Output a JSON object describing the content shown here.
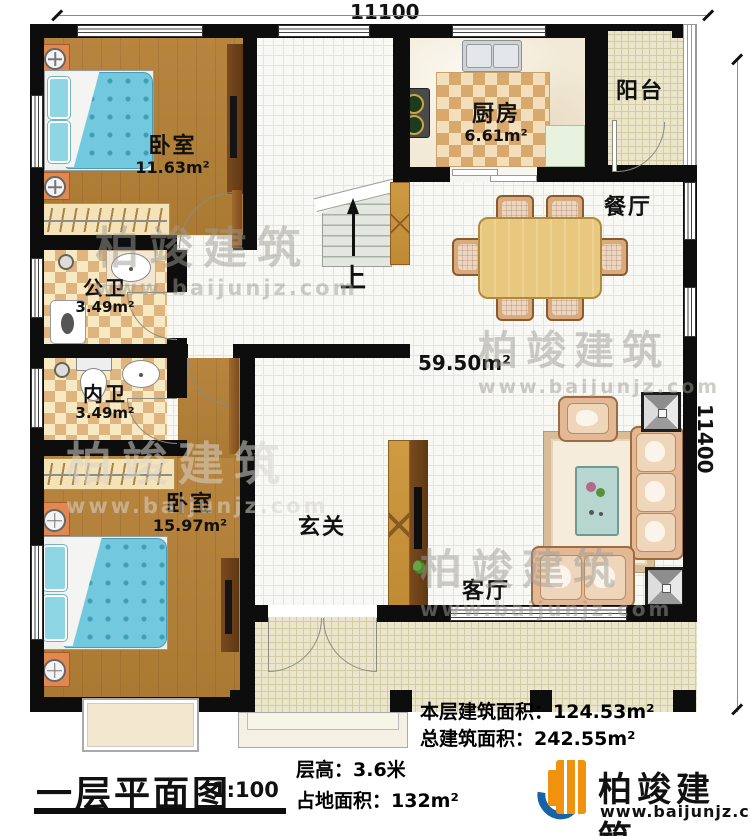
{
  "dimensions": {
    "top": "11100",
    "right": "11400"
  },
  "rooms": {
    "bedroom1": {
      "name": "卧室",
      "area": "11.63m²"
    },
    "kitchen": {
      "name": "厨房",
      "area": "6.61m²"
    },
    "balcony": {
      "name": "阳台"
    },
    "dining": {
      "name": "餐厅"
    },
    "bath_public": {
      "name": "公卫",
      "area": "3.49m²"
    },
    "bath_private": {
      "name": "内卫",
      "area": "3.49m²"
    },
    "bedroom2": {
      "name": "卧室",
      "area": "15.97m²"
    },
    "foyer": {
      "name": "玄关"
    },
    "living": {
      "name": "客厅"
    },
    "hall_area": "59.50m²",
    "stairs_up": "上"
  },
  "info": {
    "floor_area": "本层建筑面积：124.53m²",
    "total_area": "总建筑面积：242.55m²",
    "height": "层高：3.6米",
    "footprint": "占地面积：132m²"
  },
  "title": {
    "text": "一层平面图",
    "scale": "1:100"
  },
  "brand": {
    "name": "柏竣建筑",
    "url": "www.baijunjz.com"
  },
  "watermark": {
    "name": "柏竣建筑",
    "url": "www.baijunjz.com"
  },
  "colors": {
    "wall": "#0d0d0d",
    "brand_orange": "#f0920e",
    "brand_blue": "#1663a8",
    "bed": "#72c8dc"
  }
}
